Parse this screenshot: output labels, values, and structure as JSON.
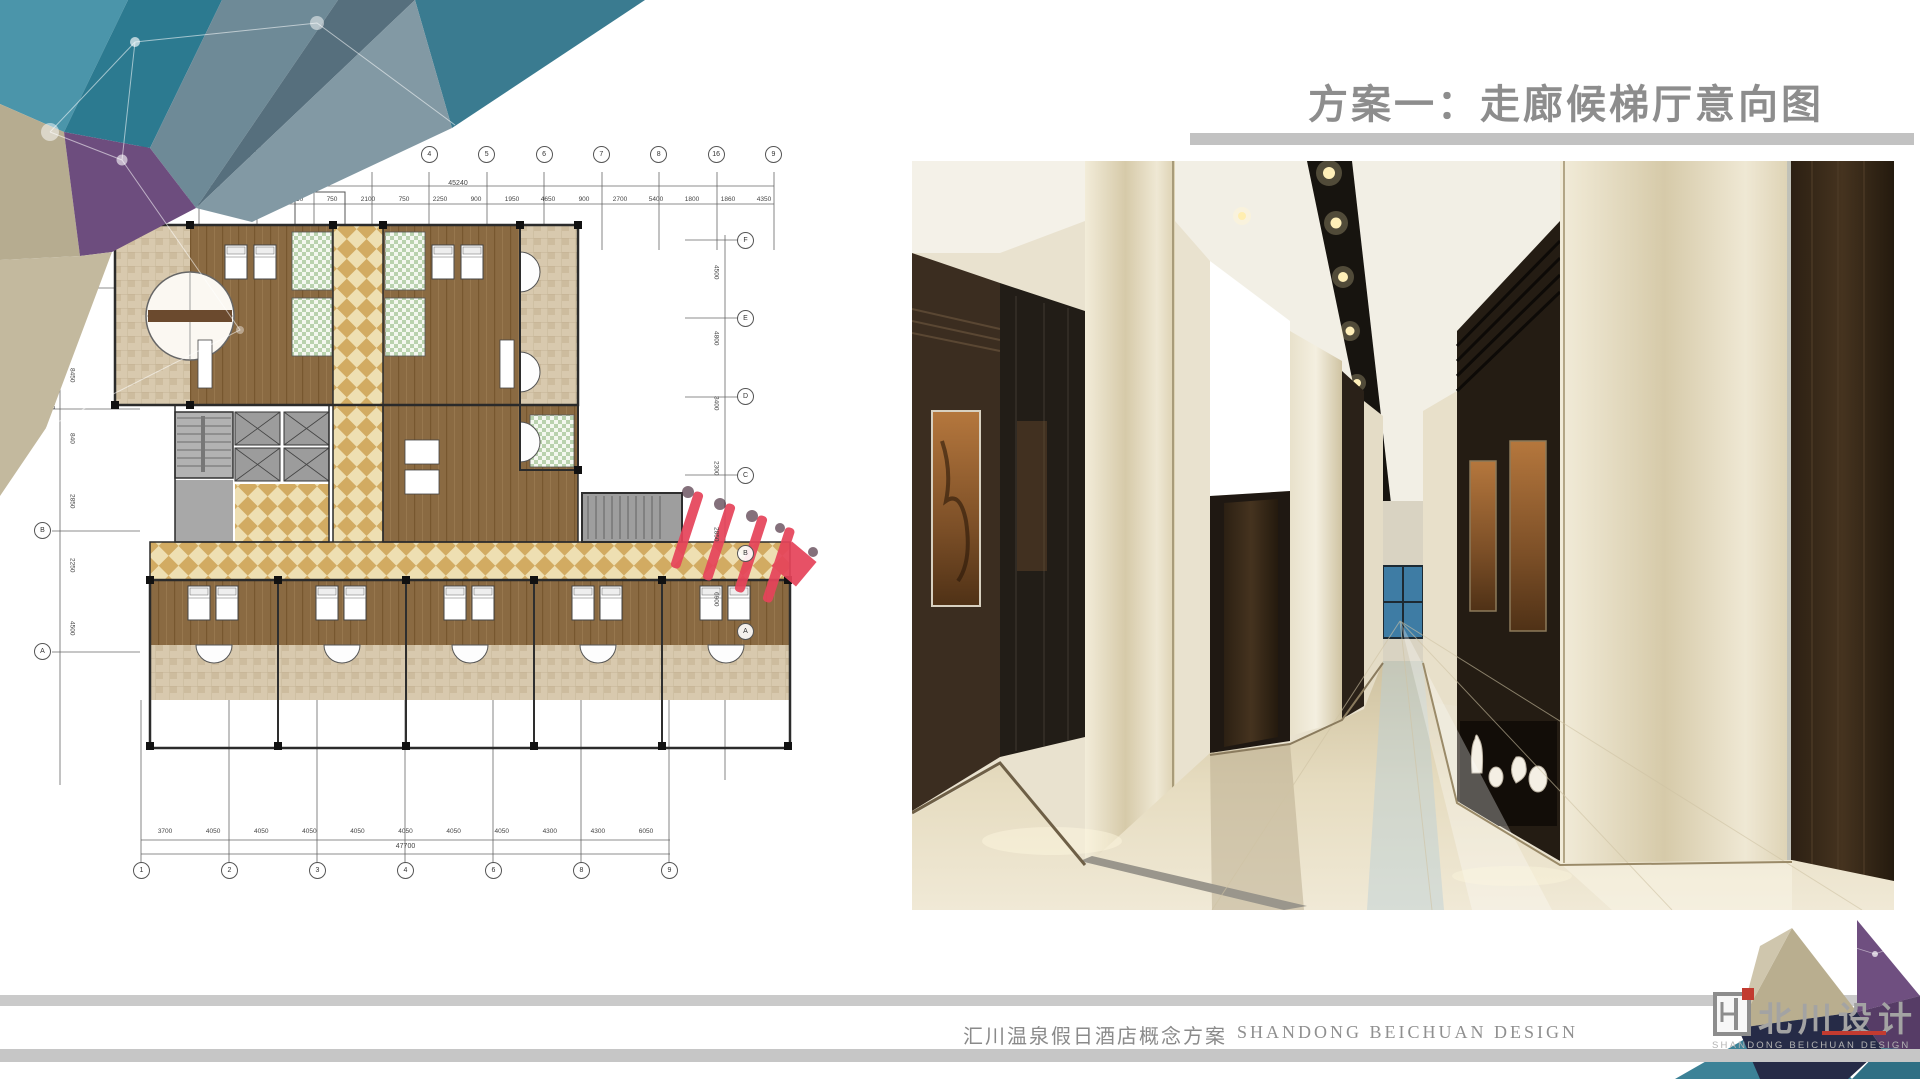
{
  "header": {
    "title": "方案一：走廊候梯厅意向图"
  },
  "footer": {
    "project_name": "汇川温泉假日酒店概念方案",
    "company_name": "SHANDONG BEICHUAN DESIGN"
  },
  "logo": {
    "name_cn": "北川设计",
    "name_en": "SHANDONG BEICHUAN DESIGN"
  },
  "colors": {
    "title_gray": "#8d8d8d",
    "underline_bar": "#c2c2c2",
    "footer_bar": "#c8c8c8",
    "accent_teal": "#3c8297",
    "accent_purple": "#6d4d7e",
    "accent_khaki": "#b6ac90",
    "accent_navy": "#262b47",
    "marker_red": "#e6435a",
    "logo_red": "#c23b30",
    "corridor_checker": "#d2ab62",
    "room_wood": "#8a6a42",
    "bath_green": "#b9d2ae",
    "render_floor": "#e3d8bc",
    "render_wall_cream": "#e6dec8",
    "render_wood_dark": "#35271a",
    "window_blue": "#3e7ca4"
  },
  "floor_plan": {
    "axis_bubbles_top": [
      "1",
      "2",
      "12",
      "13",
      "3",
      "4",
      "5",
      "6",
      "7",
      "8",
      "16",
      "9"
    ],
    "dims_top": [
      "2700",
      "800",
      "5700",
      "1800",
      "2250",
      "750",
      "2100",
      "750",
      "2250",
      "900",
      "1950",
      "4650",
      "900",
      "2700",
      "5400",
      "1800",
      "1860",
      "4350"
    ],
    "dim_top_total": "45240",
    "axis_bubbles_bottom": [
      "1",
      "2",
      "3",
      "4",
      "6",
      "8",
      "9"
    ],
    "dims_bottom": [
      "3700",
      "4050",
      "4050",
      "4050",
      "4050",
      "4050",
      "4050",
      "4050",
      "4300",
      "4300",
      "6050"
    ],
    "dim_bottom_total": "47700",
    "axis_bubbles_left": [
      "D",
      "C",
      "B",
      "A"
    ],
    "dims_left": [
      "6100",
      "8450",
      "840",
      "2850",
      "2250",
      "4500"
    ],
    "dim_left_total": "32180",
    "axis_bubbles_right": [
      "F",
      "E",
      "D",
      "C",
      "B",
      "A"
    ],
    "dims_right": [
      "4500",
      "4800",
      "3400",
      "2300",
      "2850",
      "6900"
    ]
  }
}
